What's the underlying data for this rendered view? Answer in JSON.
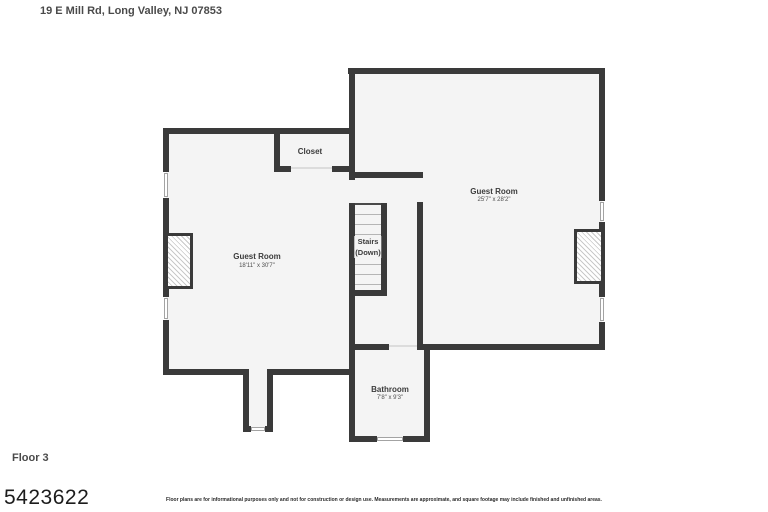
{
  "header": {
    "address": "19 E Mill Rd, Long Valley, NJ 07853"
  },
  "footer": {
    "floor_label": "Floor 3",
    "listing_number": "5423622",
    "disclaimer": "Floor plans are for informational purposes only and not for construction or design use. Measurements are approximate, and square footage may include finished and unfinished areas."
  },
  "rooms": {
    "closet": {
      "name": "Closet"
    },
    "guest_room_left": {
      "name": "Guest Room",
      "dimensions": "18'11\" x 30'7\""
    },
    "guest_room_right": {
      "name": "Guest Room",
      "dimensions": "25'7\" x 28'2\""
    },
    "stairs": {
      "name": "Stairs",
      "direction": "(Down)"
    },
    "bathroom": {
      "name": "Bathroom",
      "dimensions": "7'8\" x 9'3\""
    }
  },
  "colors": {
    "wall": "#3a3a3a",
    "floor": "#f4f4f4"
  }
}
